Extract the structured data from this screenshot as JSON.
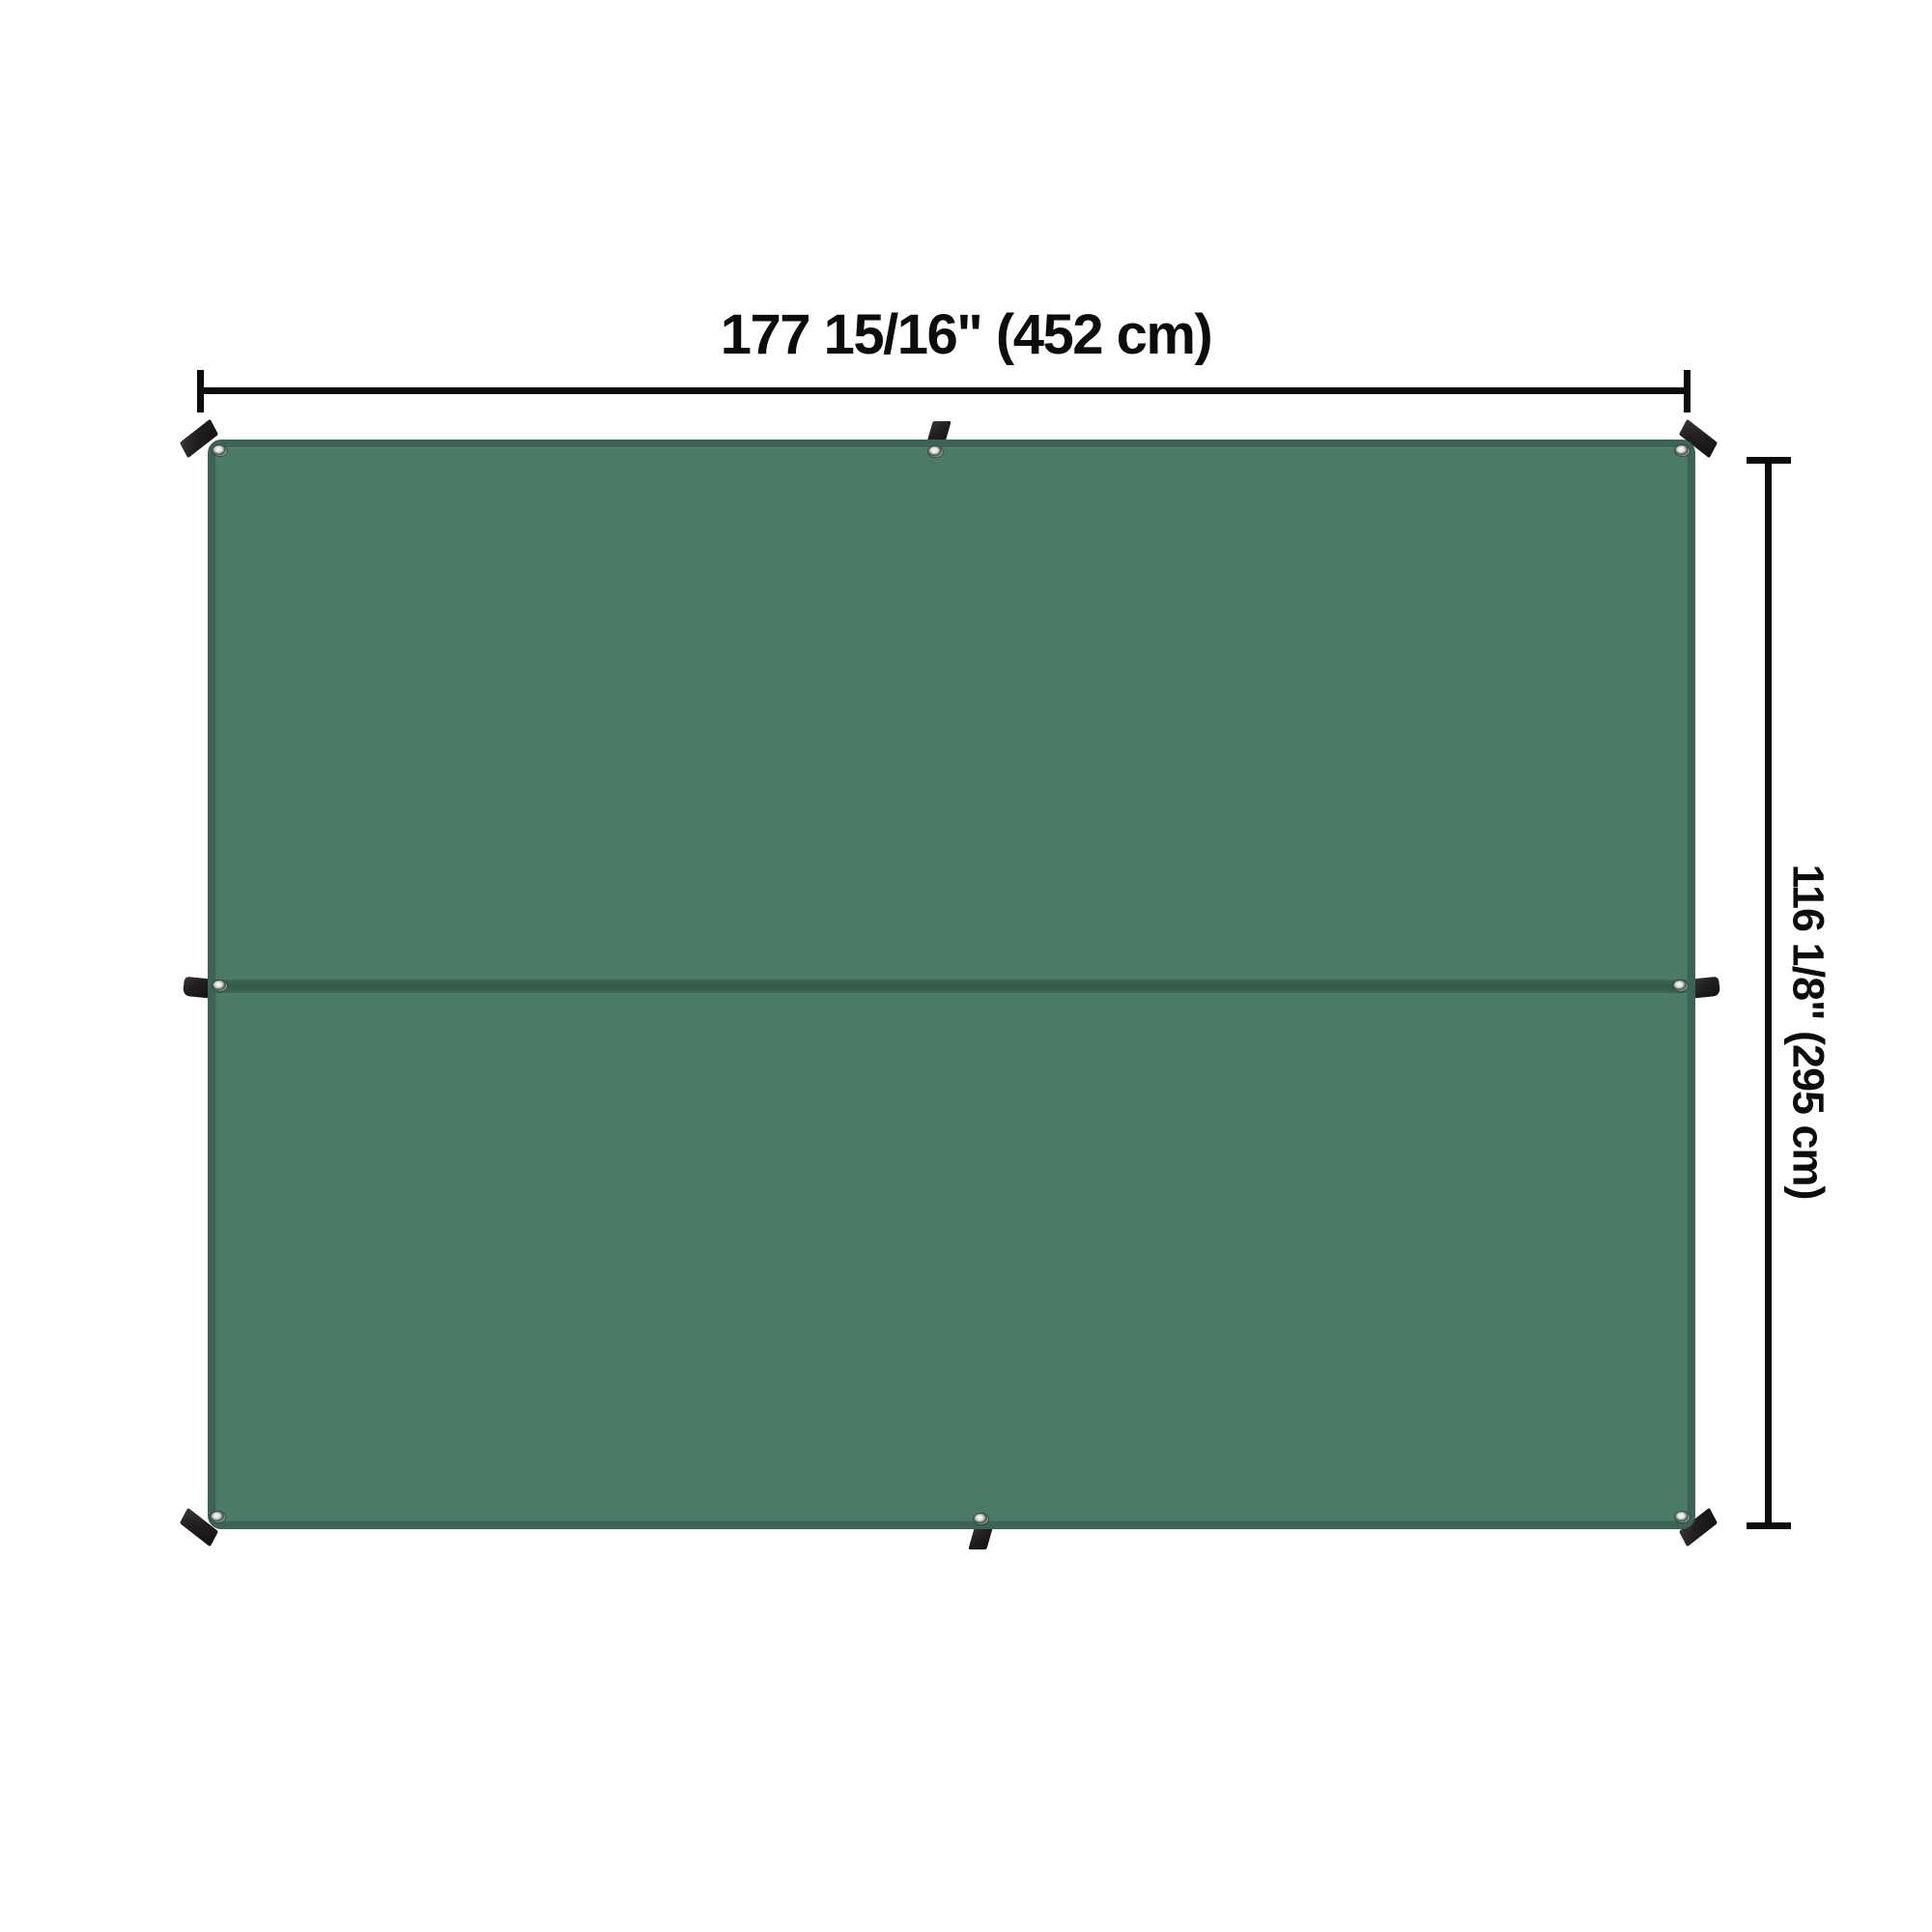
{
  "diagram": {
    "type": "product-dimension-diagram",
    "product": "tarp",
    "width_label": "177 15/16\" (452 cm)",
    "height_label": "116 1/8\" (295 cm)"
  },
  "features": {
    "grommet_count": 8,
    "tie_loop_count": 8,
    "center_seam": true
  },
  "colors": {
    "background": "#ffffff",
    "tarp_fill": "#4b7a69",
    "tarp_edge": "#3b6454",
    "seam_dark": "#35594b",
    "seam_light": "#3e6858",
    "dimension_ink": "#0c0c0c",
    "loop_black": "#211e1e",
    "grommet_ring": "#d8dcd6",
    "grommet_hole": "#454d48"
  }
}
